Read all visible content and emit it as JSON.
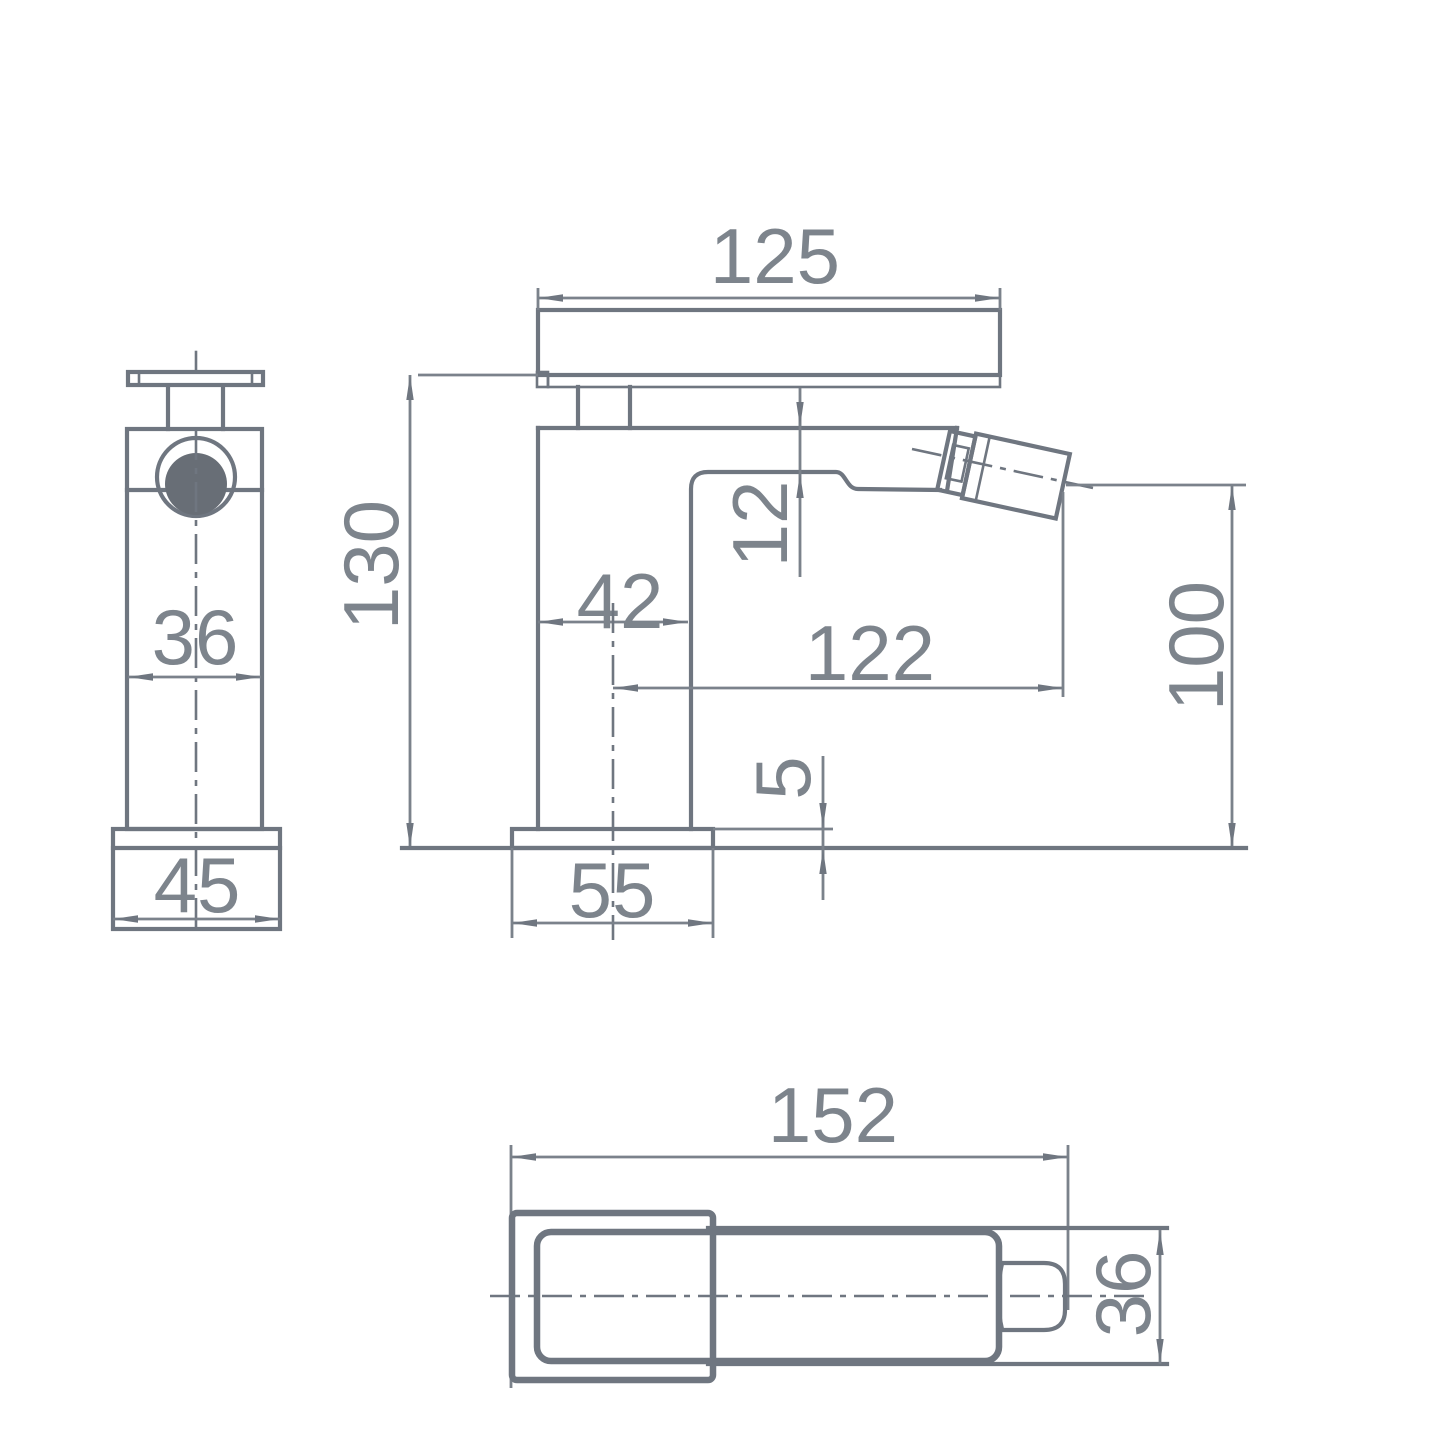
{
  "drawing": {
    "type": "technical-dimension-drawing",
    "subject": "mono bidet mixer tap, three orthographic views",
    "units": "mm",
    "colors": {
      "line": "#6f7680",
      "text": "#7d848c",
      "dark_fill": "#686e76",
      "background": "#ffffff"
    }
  },
  "dimensions": {
    "front": {
      "body_width": "36",
      "base_width": "45"
    },
    "side": {
      "lever_length": "125",
      "overall_height": "130",
      "body_depth": "42",
      "spout_drop": "12",
      "spout_reach": "122",
      "outlet_height": "100",
      "base_thickness": "5",
      "base_length": "55"
    },
    "plan": {
      "overall_length": "152",
      "body_width": "36"
    }
  }
}
